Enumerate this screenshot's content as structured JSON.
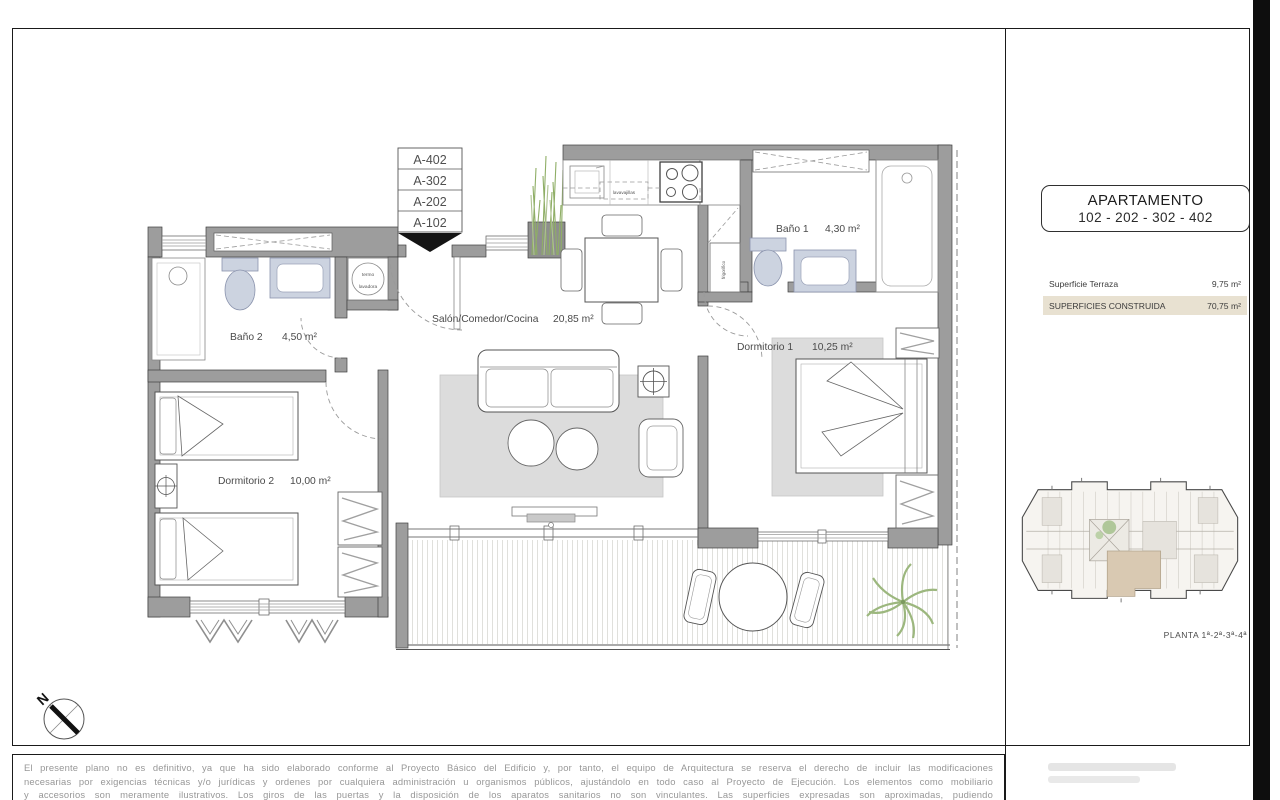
{
  "plan": {
    "unit_stack": [
      "A-402",
      "A-302",
      "A-202",
      "A-102"
    ],
    "rooms": {
      "living": {
        "name": "Salón/Comedor/Cocina",
        "area": "20,85 m²"
      },
      "bath1": {
        "name": "Baño 1",
        "area": "4,30 m²"
      },
      "bed1": {
        "name": "Dormitorio 1",
        "area": "10,25 m²"
      },
      "bath2": {
        "name": "Baño 2",
        "area": "4,50 m²"
      },
      "bed2": {
        "name": "Dormitorio 2",
        "area": "10,00 m²"
      }
    },
    "appliances": {
      "dishwasher": "lavavajillas",
      "fridge": "frigorífico",
      "water_heater": "termo",
      "washer": "lavadora"
    },
    "compass_north": "N"
  },
  "panel": {
    "title": "APARTAMENTO",
    "subtitle": "102 - 202 - 302 - 402",
    "surfaces": [
      {
        "label": "Superficie Terraza",
        "value": "9,75 m²"
      },
      {
        "label": "SUPERFICIES CONSTRUIDA",
        "value": "70,75 m²"
      }
    ],
    "keyplan_caption": "PLANTA 1ª-2ª-3ª-4ª"
  },
  "disclaimer": {
    "line1": "El presente plano no es definitivo, ya que ha sido elaborado conforme al Proyecto Básico del Edificio y, por tanto, el equipo de Arquitectura se reserva el derecho de incluir las modificaciones",
    "line2": "necesarias por exigencias técnicas y/o jurídicas y ordenes por cualquiera administración u organismos públicos, ajustándolo en todo caso al Proyecto de Ejecución. Los elementos como mobiliario",
    "line3": "y accesorios son meramente ilustrativos. Los giros de las puertas y la disposición de los aparatos sanitarios no son vinculantes. Las superficies expresadas son aproximadas, pudiendo"
  },
  "colors": {
    "wall": "#9d9d9d",
    "fixture_blue": "#ccd3e0",
    "highlight_beige": "#e8e1d1",
    "plant_green": "#9cb77e",
    "accent_black": "#0e0e0e"
  }
}
